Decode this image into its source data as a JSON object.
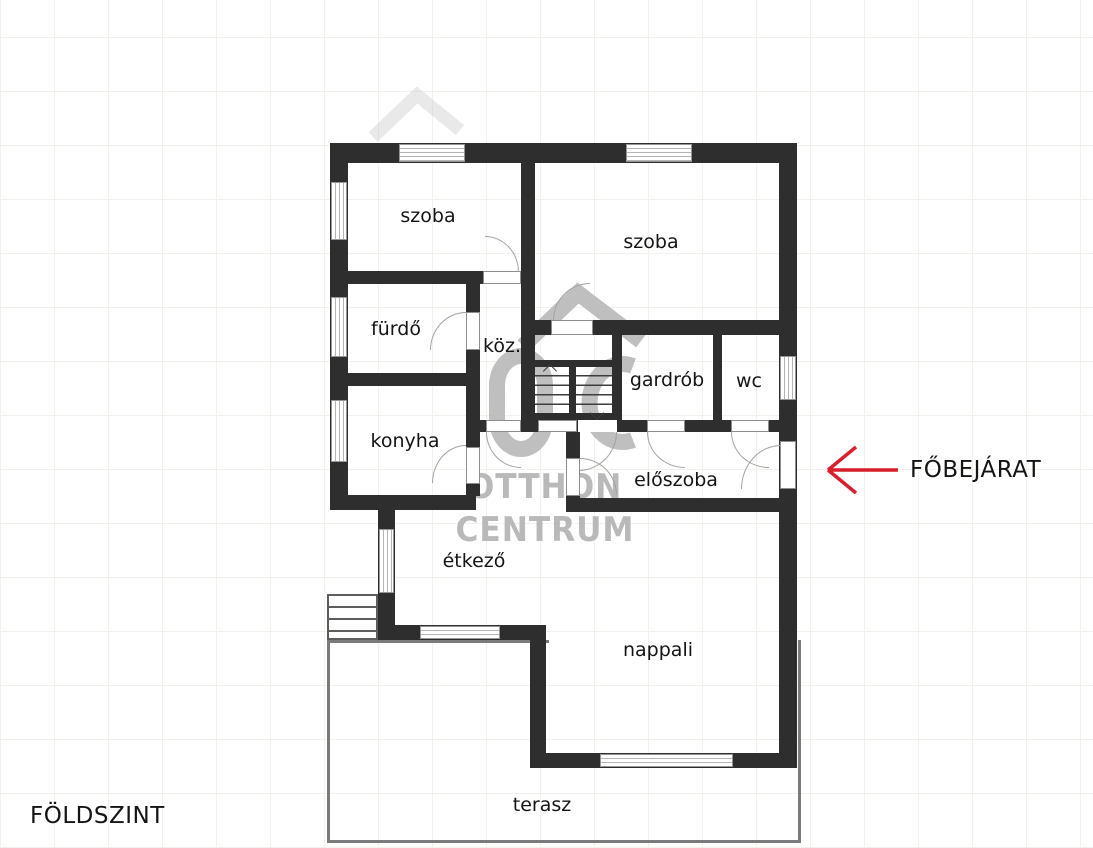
{
  "plan": {
    "floor_label": "FÖLDSZINT",
    "entrance_label": "FŐBEJÁRAT",
    "room_labels": {
      "szoba_top_left": "szoba",
      "szoba_top_right": "szoba",
      "furdo": "fürdő",
      "koz": "köz.",
      "gardrob": "gardrób",
      "wc": "wc",
      "konyha": "konyha",
      "eloszoba": "előszoba",
      "etkezo": "étkező",
      "nappali": "nappali",
      "terasz": "terasz"
    }
  },
  "watermark": {
    "line1": "OTTHON",
    "line2": "CENTRUM"
  },
  "icons": {
    "entrance_arrow": "left-arrow",
    "stairs_up": "up-chevron",
    "stairs_down": "down-chevron"
  },
  "colors": {
    "wall": "#2e2e2e",
    "entrance_arrow": "#d91f2e",
    "watermark": "#b9b9b9",
    "text": "#141414",
    "terrace_line": "#7b7b7b"
  }
}
